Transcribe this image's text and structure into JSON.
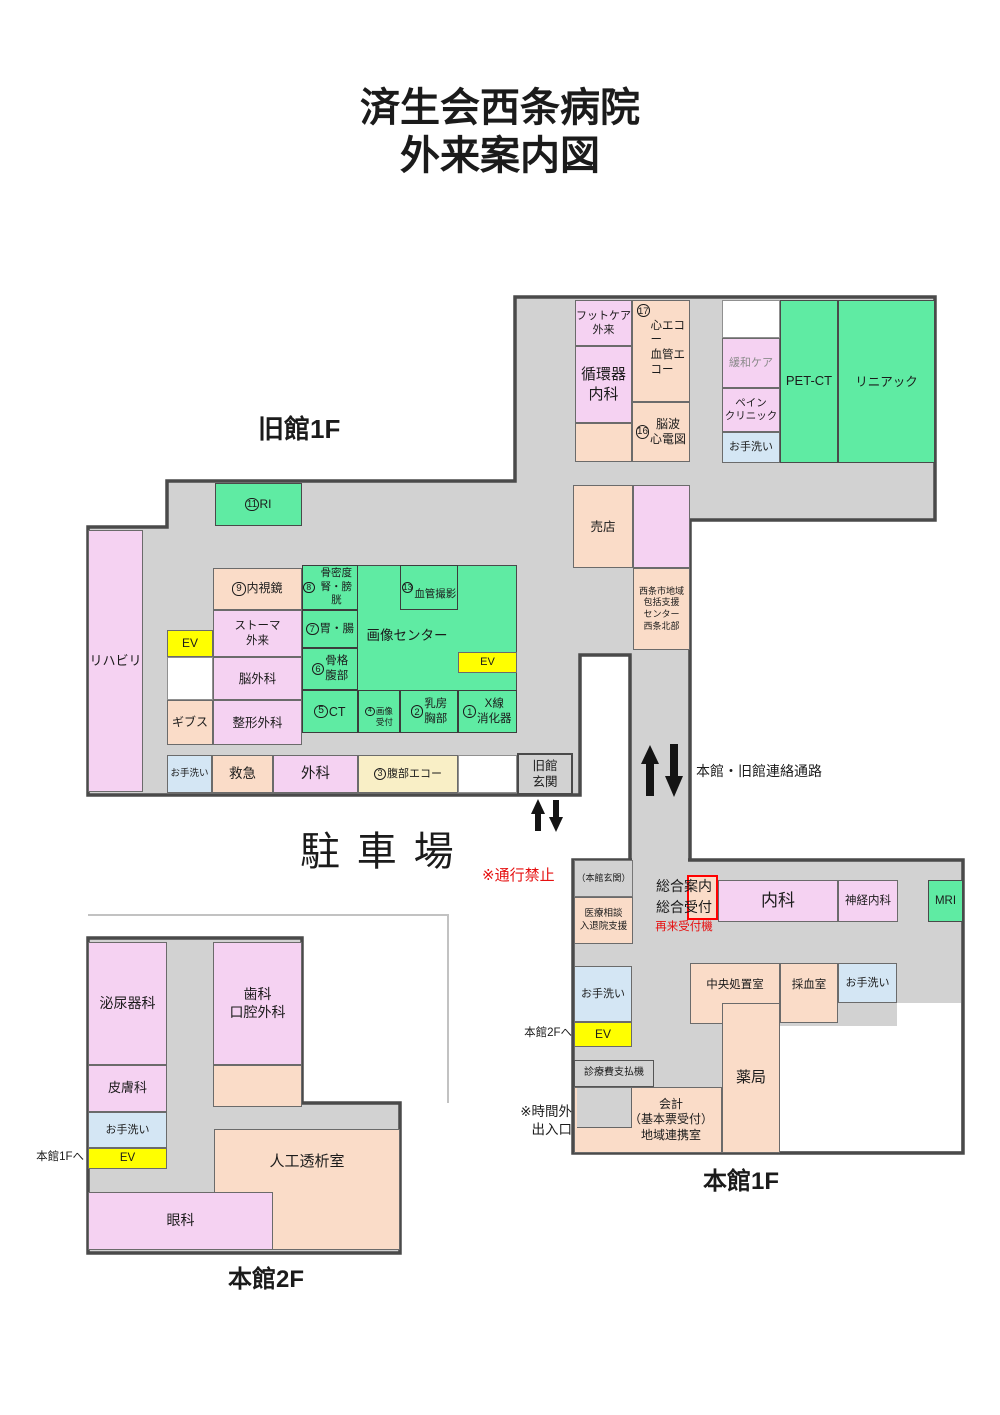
{
  "title": {
    "line1": "済生会西条病院",
    "line2": "外来案内図"
  },
  "common": {
    "toilet": "お手洗い",
    "ev": "EV"
  },
  "annotations": {
    "parking": "駐車場",
    "no_pass": "※通行禁止",
    "corridor": "本館・旧館連絡通路"
  },
  "old_1f": {
    "name": "旧館1F",
    "rooms": {
      "footcare": "フットケア\n外来",
      "cardiology": "循環器\n内科",
      "echo17": "⑰\n心エコー\n血管エコー",
      "eeg16": "⑯脳波\n心電図",
      "palliative": "緩和ケア",
      "pain": "ペイン\nクリニック",
      "petct": "PET-CT",
      "linac": "リニアック",
      "shop": "売店",
      "support_center": "西条市地域\n包括支援\nセンター\n西条北部",
      "ri11": "⑪RI",
      "rehab": "リハビリ",
      "endoscopy9": "⑨内視鏡",
      "stoma": "ストーマ\n外来",
      "neurosurgery": "脳外科",
      "cast": "ギブス",
      "orthopedics": "整形外科",
      "imaging_center": "画像センター",
      "bone8": "⑧骨密度\n腎・膀胱",
      "stomach7": "⑦胃・腸",
      "skeleton6": "⑥骨格\n腹部",
      "ct5": "⑤CT",
      "reception4": "④\n画像\n受付",
      "breast2": "②乳房\n胸部",
      "xray1": "①X線\n消化器",
      "angio13": "⑬\n血管撮影",
      "emergency": "救急",
      "surgery": "外科",
      "abdominal_echo3": "③腹部エコー",
      "entrance": "旧館\n玄関"
    }
  },
  "main_1f": {
    "name": "本館1F",
    "rooms": {
      "entrance_label": "（本館玄関）",
      "consult": "医療相談\n入退院支援",
      "reception": "総合案内\n総合受付",
      "recheck_machine": "再来受付機",
      "internal_medicine": "内科",
      "neurology": "神経内科",
      "mri": "MRI",
      "central_treatment": "中央処置室",
      "blood_sampling": "採血室",
      "pharmacy": "薬局",
      "payment_machine": "診療費支払機",
      "accounting": "会計\n（基本票受付）\n地域連携室",
      "to_2f": "本館2Fへ",
      "after_hours": "※時間外\n出入口"
    }
  },
  "main_2f": {
    "name": "本館2F",
    "rooms": {
      "urology": "泌尿器科",
      "dental": "歯科\n口腔外科",
      "dermatology": "皮膚科",
      "dialysis": "人工透析室",
      "ophthalmology": "眼科",
      "to_1f": "本館1Fへ"
    }
  },
  "colors": {
    "department_pink": "#f5d2f2",
    "exam_peach": "#fadcc8",
    "imaging_green": "#5feba3",
    "toilet_blue": "#d4e6f4",
    "elevator_yellow": "#ffff00",
    "echo_cream": "#f9efc6",
    "corridor_gray": "#d2d2d2",
    "outline_dark": "#4a4a4a",
    "alert_red": "#e61010"
  }
}
